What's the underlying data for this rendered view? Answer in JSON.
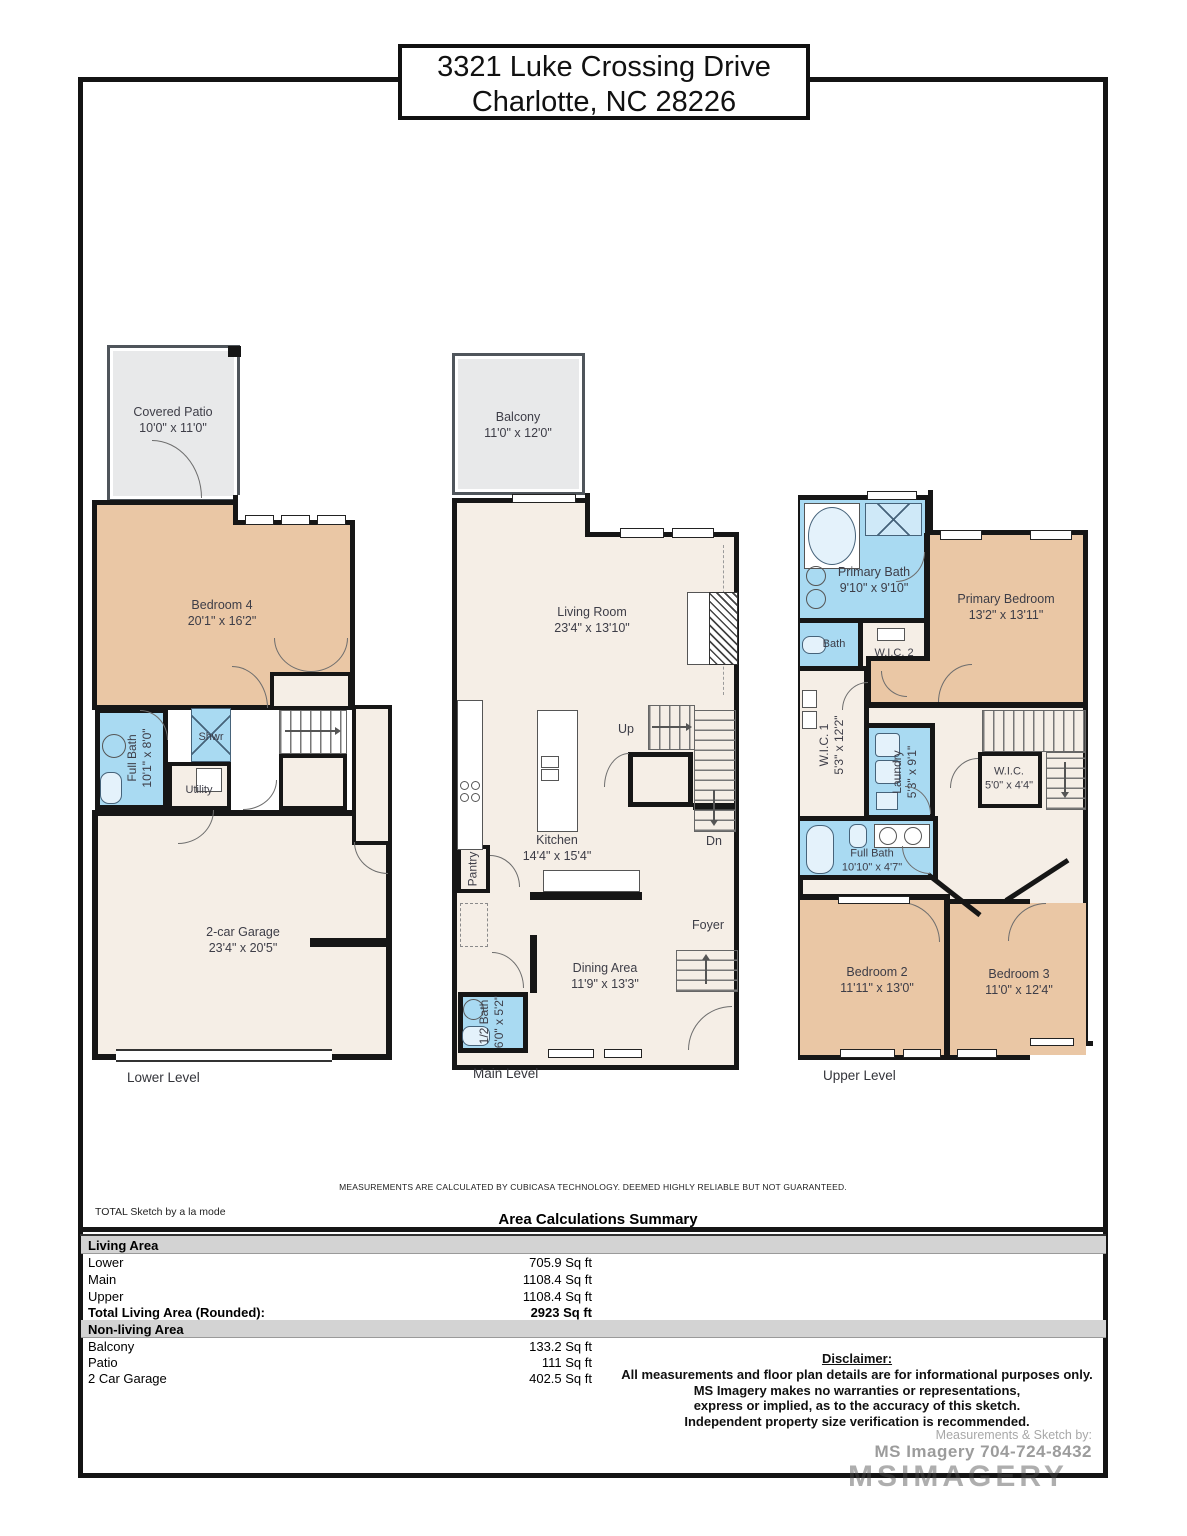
{
  "title": {
    "line1": "3321 Luke Crossing Drive",
    "line2": "Charlotte, NC 28226"
  },
  "levels": {
    "lower": {
      "label": "Lower Level",
      "covered_patio": {
        "name": "Covered Patio",
        "dims": "10'0\" x 11'0\""
      },
      "bedroom4": {
        "name": "Bedroom 4",
        "dims": "20'1\" x 16'2\""
      },
      "full_bath": {
        "name": "Full Bath",
        "dims": "10'1\" x 8'0\""
      },
      "shower": {
        "name": "Shwr"
      },
      "utility": {
        "name": "Utility"
      },
      "garage": {
        "name": "2-car Garage",
        "dims": "23'4\" x 20'5\""
      }
    },
    "main": {
      "label": "Main Level",
      "balcony": {
        "name": "Balcony",
        "dims": "11'0\" x 12'0\""
      },
      "living_room": {
        "name": "Living Room",
        "dims": "23'4\" x 13'10\""
      },
      "kitchen": {
        "name": "Kitchen",
        "dims": "14'4\" x 15'4\""
      },
      "pantry": {
        "name": "Pantry"
      },
      "dining": {
        "name": "Dining Area",
        "dims": "11'9\" x 13'3\""
      },
      "half_bath": {
        "name": "1/2 Bath",
        "dims": "6'0\" x 5'2\""
      },
      "foyer": {
        "name": "Foyer"
      },
      "up": "Up",
      "dn": "Dn"
    },
    "upper": {
      "label": "Upper Level",
      "primary_bath": {
        "name": "Primary Bath",
        "dims": "9'10\" x 9'10\""
      },
      "primary_bedroom": {
        "name": "Primary Bedroom",
        "dims": "13'2\" x 13'11\""
      },
      "bath": {
        "name": "Bath"
      },
      "wic2": {
        "name": "W.I.C. 2"
      },
      "wic1": {
        "name": "W.I.C. 1",
        "dims": "5'3\" x 12'2\""
      },
      "laundry": {
        "name": "Laundry",
        "dims": "5'3\" x 9'1\""
      },
      "wic": {
        "name": "W.I.C.",
        "dims": "5'0\" x 4'4\""
      },
      "full_bath": {
        "name": "Full Bath",
        "dims": "10'10\" x 4'7\""
      },
      "bedroom2": {
        "name": "Bedroom 2",
        "dims": "11'11\" x 13'0\""
      },
      "bedroom3": {
        "name": "Bedroom 3",
        "dims": "11'0\" x 12'4\""
      }
    }
  },
  "footer": {
    "measurement_note": "MEASUREMENTS ARE CALCULATED BY CUBICASA TECHNOLOGY. DEEMED HIGHLY RELIABLE BUT NOT GUARANTEED.",
    "sketch_logo": "TOTAL Sketch by a la mode",
    "summary_title": "Area Calculations Summary",
    "living_area": {
      "header": "Living Area",
      "rows": [
        {
          "label": "Lower",
          "value": "705.9 Sq ft"
        },
        {
          "label": "Main",
          "value": "1108.4 Sq ft"
        },
        {
          "label": "Upper",
          "value": "1108.4 Sq ft"
        }
      ],
      "total": {
        "label": "Total Living Area (Rounded):",
        "value": "2923 Sq ft"
      }
    },
    "nonliving_area": {
      "header": "Non-living Area",
      "rows": [
        {
          "label": "Balcony",
          "value": "133.2 Sq ft"
        },
        {
          "label": "Patio",
          "value": "111 Sq ft"
        },
        {
          "label": "2 Car Garage",
          "value": "402.5 Sq ft"
        }
      ]
    },
    "disclaimer": {
      "title": "Disclaimer:",
      "lines": [
        "All measurements and floor plan details are for informational purposes only.",
        "MS Imagery makes no warranties or representations,",
        "express or implied, as to the accuracy of this sketch.",
        "Independent property size verification is recommended."
      ]
    },
    "credit": {
      "line1": "Measurements & Sketch by:",
      "line2": "MS Imagery  704-724-8432"
    },
    "watermark": "MSIMAGERY"
  },
  "colors": {
    "bedroom": "#eac7a5",
    "bath": "#a9daf2",
    "floor": "#f5eee6",
    "outdoor": "#e8e9ea",
    "wall": "#161616"
  }
}
